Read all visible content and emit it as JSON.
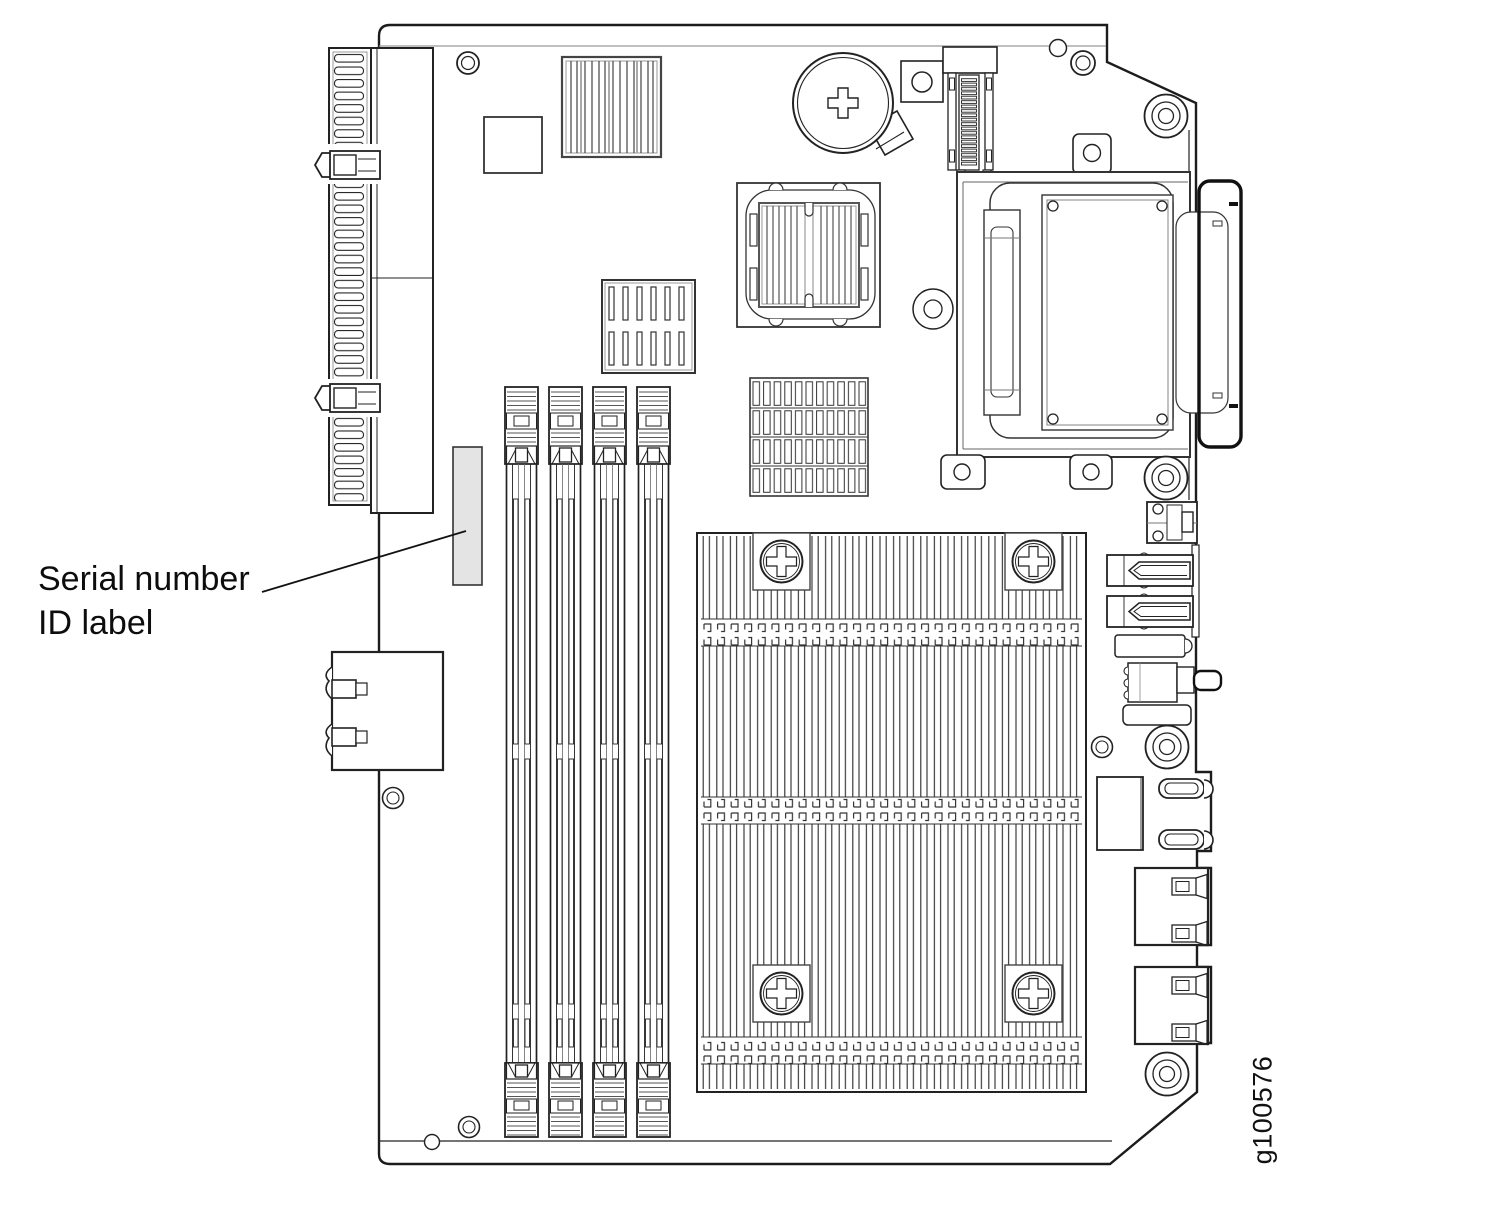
{
  "diagram": {
    "callout": {
      "line1": "Serial number",
      "line2": "ID label"
    },
    "figure_id": "g100576",
    "colors": {
      "background": "#ffffff",
      "label_fill": "#e4e4e4",
      "line_dark": "#1c1c1c"
    }
  }
}
